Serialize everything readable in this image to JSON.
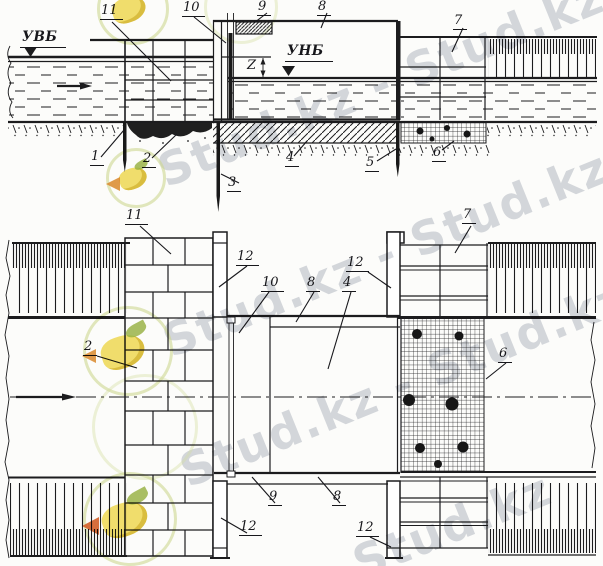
{
  "watermark": {
    "run_a": "Stud.kz - Stud.kz",
    "run_b": "Stud.kz - Stud.kz",
    "run_c": "Stud.kz - Stud.kz",
    "run_d": "Stud.kz"
  },
  "section_view": {
    "upstream_level_label": "УВБ",
    "downstream_level_label": "УНБ",
    "head_dimension_label": "Z",
    "callouts": {
      "n1": "1",
      "n2": "2",
      "n3": "3",
      "n4": "4",
      "n5": "5",
      "n6": "6",
      "n7": "7",
      "n8": "8",
      "n9": "9",
      "n10": "10",
      "n11": "11"
    }
  },
  "plan_view": {
    "callouts": {
      "n2": "2",
      "n4": "4",
      "n6": "6",
      "n7": "7",
      "n8_top": "8",
      "n8_bottom": "8",
      "n9": "9",
      "n10": "10",
      "n11": "11",
      "n12_top_left": "12",
      "n12_top_right": "12",
      "n12_bottom_left": "12",
      "n12_bottom_right": "12"
    }
  }
}
